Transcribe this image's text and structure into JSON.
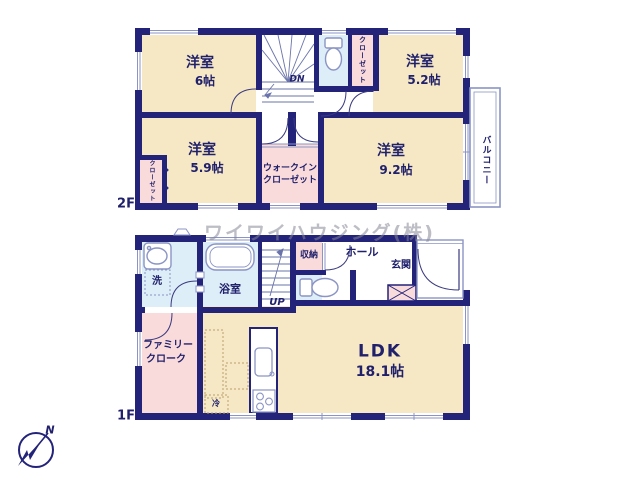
{
  "plan_title": "2階建て間取り図",
  "watermark": "ワイワイハウジング(株)",
  "compass": {
    "north_label": "N"
  },
  "floor2": {
    "label": "2F",
    "rooms": {
      "room6": {
        "name": "洋室",
        "size": "6帖"
      },
      "room52": {
        "name": "洋室",
        "size": "5.2帖"
      },
      "room59": {
        "name": "洋室",
        "size": "5.9帖"
      },
      "room92": {
        "name": "洋室",
        "size": "9.2帖"
      },
      "wic": {
        "line1": "ウォークイン",
        "line2": "クローゼット"
      },
      "closet_top": "クローゼット",
      "closet_left": "クローゼット",
      "balcony": "バルコニー",
      "stairs_down": "DN"
    }
  },
  "floor1": {
    "label": "1F",
    "rooms": {
      "ldk": {
        "name": "LDK",
        "size": "18.1帖"
      },
      "bath": "浴室",
      "washroom": "洗",
      "storage": "収納",
      "hall": "ホール",
      "entrance": "玄関",
      "family_closet": {
        "line1": "ファミリー",
        "line2": "クローク"
      },
      "fridge": "冷",
      "stairs_up": "UP"
    }
  },
  "colors": {
    "wall": "#23237a",
    "room_fill": "#f6e8c5",
    "closet_fill": "#fadbdb",
    "wet_fill": "#ddeef8",
    "fixture_line": "#8b94c4",
    "text": "#20206b",
    "watermark_gray": "#8a8a96"
  }
}
